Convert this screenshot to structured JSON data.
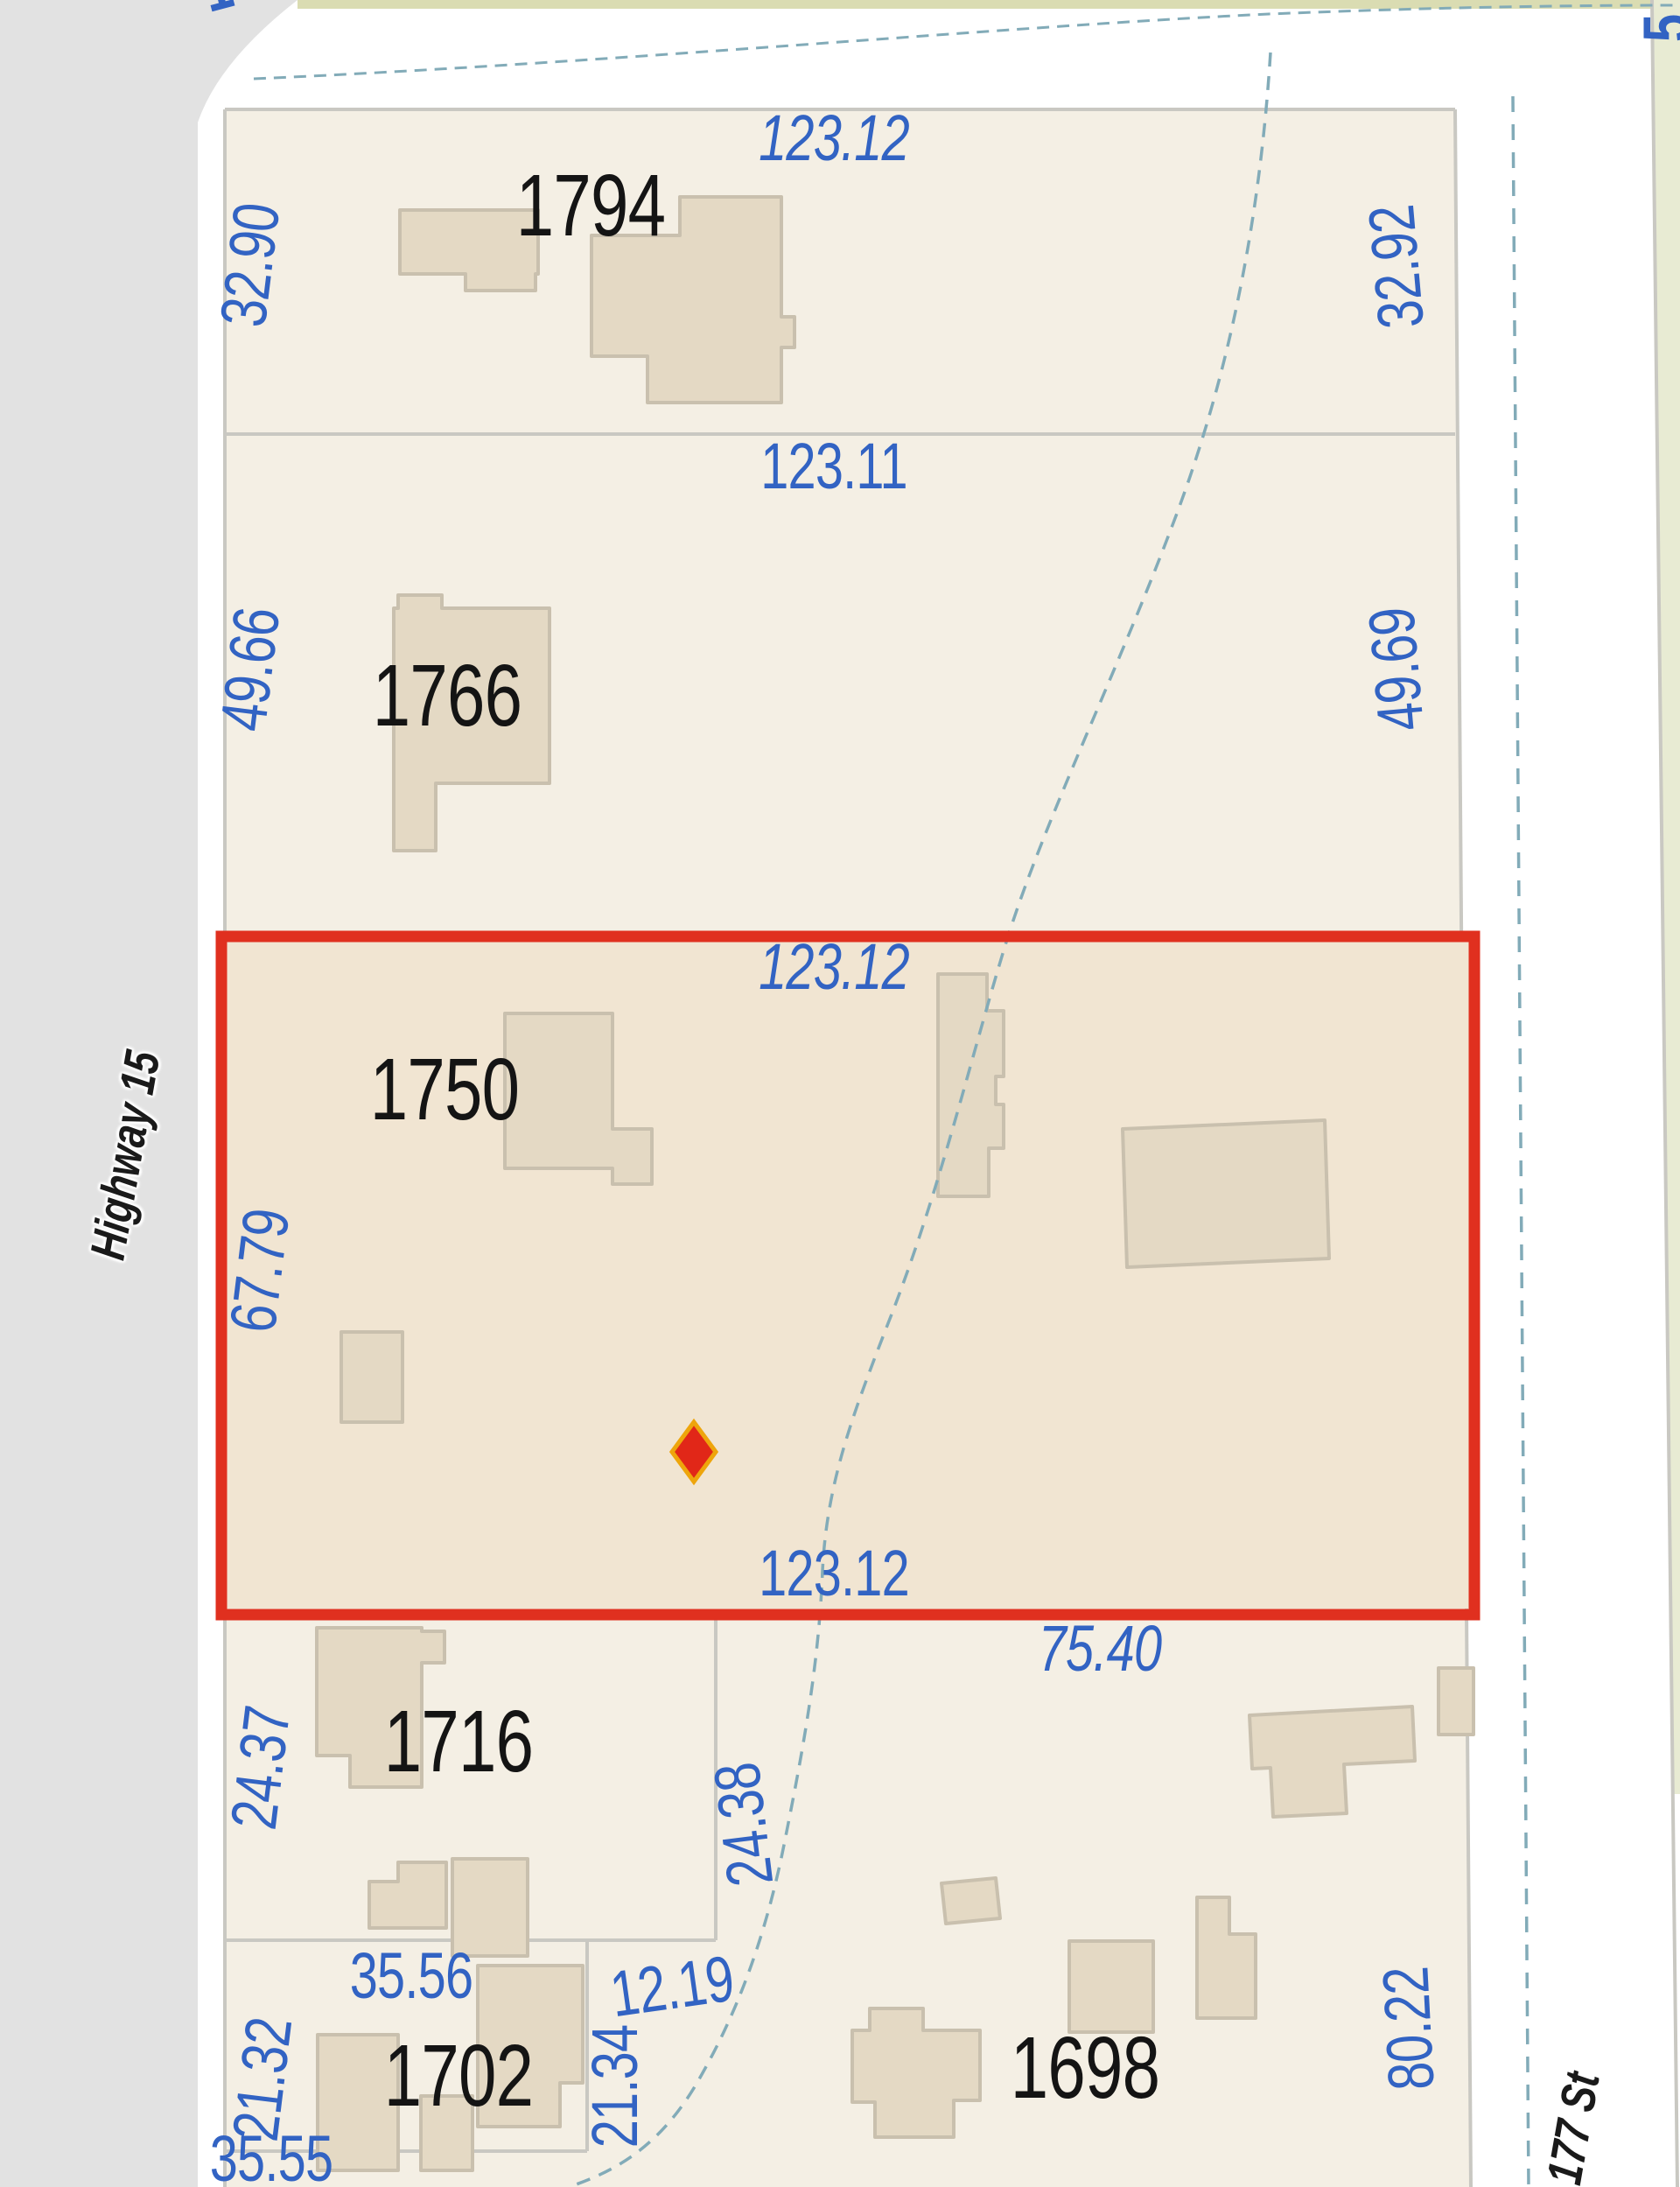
{
  "app": {
    "type": "parcel-map-viewer"
  },
  "streets": [
    {
      "name": "Highway 15",
      "side": "left"
    },
    {
      "name": "177 St",
      "side": "right"
    }
  ],
  "selected_parcel": {
    "id": "1750",
    "top_dimension": "123.12",
    "bottom_dimension": "123.12",
    "left_dimension": "67.79",
    "border_color": "#e0301f",
    "marker": {
      "shape": "diamond",
      "fill": "#e12718",
      "outline": "#eea50c"
    }
  },
  "parcels": [
    {
      "id": "1794",
      "dimensions": {
        "top": "123.12",
        "left": "32.90",
        "right": "32.92"
      }
    },
    {
      "id": "1766",
      "dimensions": {
        "top": "123.11",
        "left": "49.66",
        "right": "49.69"
      }
    },
    {
      "id": "1750",
      "dimensions": {
        "top": "123.12",
        "left": "67.79",
        "bottom": "123.12"
      }
    },
    {
      "id": "1716",
      "dimensions": {
        "left": "24.37",
        "right": "24.38"
      }
    },
    {
      "id": "1702",
      "dimensions": {
        "top": "35.56",
        "left": "21.32",
        "right": "21.34",
        "bottom": "35.55"
      }
    },
    {
      "id": "1698",
      "dimensions": {
        "top": "75.40",
        "right": "80.22",
        "top_left": "12.19"
      }
    }
  ],
  "labels": {
    "p1794": "1794",
    "p1766": "1766",
    "p1750": "1750",
    "p1716": "1716",
    "p1702": "1702",
    "p1698": "1698",
    "d123_12_top": "123.12",
    "d123_11": "123.11",
    "d123_12_mid": "123.12",
    "d123_12_bot": "123.12",
    "d75_40": "75.40",
    "d32_90": "32.90",
    "d32_92": "32.92",
    "d49_66": "49.66",
    "d49_69": "49.69",
    "d67_79": "67.79",
    "d24_37": "24.37",
    "d24_38": "24.38",
    "d35_56": "35.56",
    "d12_19": "12.19",
    "d21_32": "21.32",
    "d21_34": "21.34",
    "d35_55": "35.55",
    "d80_22": "80.22",
    "highway": "Highway 15",
    "street": "177 St",
    "frag_tl": "1",
    "frag_tr": "5",
    "frag_right_mid": "00.78",
    "frag_rb1": "2",
    "frag_rb2": "2"
  },
  "colors": {
    "parcel_fill": "#f4efe4",
    "selected_fill": "#f1e5d2",
    "selected_border": "#e0301f",
    "road_gray": "#e2e2e2",
    "building_fill": "#e4d9c4",
    "building_stroke": "#c9c0ae",
    "boundary_line": "#c9c8c2",
    "dimension_text": "#3263c3",
    "street_text": "#1a1a1a",
    "creek_dash": "#82abb8",
    "green_strip": "#e8ebd3",
    "olive_strip": "#dadcb2"
  }
}
